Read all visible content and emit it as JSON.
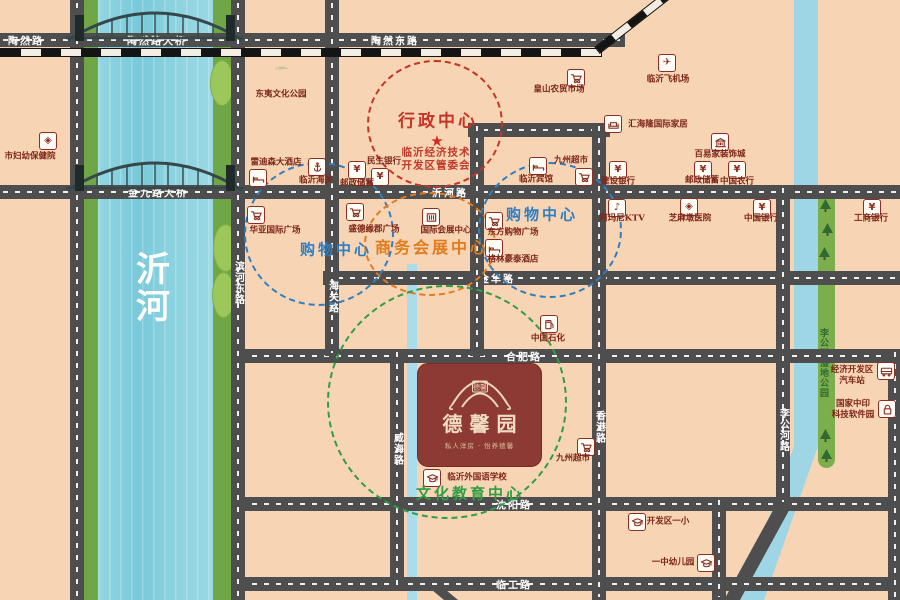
{
  "palette": {
    "bg": "#f7d4b4",
    "road": "#4e4e4e",
    "water": "#85cedd",
    "bank": "#6fa646",
    "canal": "#9fd6e6",
    "island": "#9cc75a",
    "zone_red": "#c43527",
    "zone_blue": "#2f7ec2",
    "zone_orange": "#e07b1e",
    "zone_green": "#2f9e44",
    "poi_text": "#7c2418",
    "project_bg": "#8c3a33"
  },
  "river": {
    "name": "沂河",
    "chars": [
      "沂",
      "河"
    ]
  },
  "parks": {
    "wetland_label": "李公河湿地公园"
  },
  "project": {
    "name": "德馨园",
    "seal": "德馨",
    "tagline": "私人洋房 · 怡养德馨"
  },
  "roads": {
    "h": [
      {
        "x": 0,
        "y": 33,
        "len": 625,
        "labels": [
          {
            "t": "陶然路",
            "at": 26
          },
          {
            "t": "陶然路大桥",
            "at": 157
          },
          {
            "t": "陶然东路",
            "at": 395
          }
        ]
      },
      {
        "x": 0,
        "y": 185,
        "len": 900,
        "labels": [
          {
            "t": "金九路大桥",
            "at": 158
          },
          {
            "t": "沂河路",
            "at": 450
          }
        ]
      },
      {
        "x": 323,
        "y": 271,
        "len": 577,
        "labels": [
          {
            "t": "金华路",
            "at": 497
          }
        ]
      },
      {
        "x": 237,
        "y": 349,
        "len": 663,
        "labels": [
          {
            "t": "合肥路",
            "at": 524
          }
        ]
      },
      {
        "x": 237,
        "y": 497,
        "len": 663,
        "labels": [
          {
            "t": "沈阳路",
            "at": 514
          }
        ]
      },
      {
        "x": 237,
        "y": 577,
        "len": 663,
        "labels": [
          {
            "t": "临工路",
            "at": 514
          }
        ]
      },
      {
        "x": 468,
        "y": 123,
        "len": 142,
        "labels": []
      }
    ],
    "v": [
      {
        "x": 70,
        "y": 0,
        "len": 600,
        "labels": []
      },
      {
        "x": 231,
        "y": 0,
        "len": 600,
        "labels": [
          {
            "t": "滨河东路",
            "at": 283
          }
        ]
      },
      {
        "x": 325,
        "y": 0,
        "len": 356,
        "labels": [
          {
            "t": "海关路",
            "at": 297
          }
        ]
      },
      {
        "x": 470,
        "y": 123,
        "len": 233,
        "labels": []
      },
      {
        "x": 592,
        "y": 123,
        "len": 477,
        "labels": [
          {
            "t": "香港路",
            "at": 427
          }
        ]
      },
      {
        "x": 390,
        "y": 349,
        "len": 241,
        "labels": [
          {
            "t": "威海路",
            "at": 449
          }
        ]
      },
      {
        "x": 776,
        "y": 185,
        "len": 320,
        "labels": [
          {
            "t": "李公河路",
            "at": 430
          }
        ]
      },
      {
        "x": 712,
        "y": 497,
        "len": 103,
        "labels": []
      },
      {
        "x": 888,
        "y": 349,
        "len": 251,
        "labels": []
      }
    ]
  },
  "zones": [
    {
      "label": "行政中心",
      "color": "#c43527",
      "cx": 433,
      "cy": 122,
      "rx": 66,
      "ry": 62,
      "lx": 438,
      "ly": 119,
      "fs": 17,
      "star": {
        "x": 437,
        "y": 141
      },
      "sub": [
        "临沂经济技术",
        "开发区管委会"
      ],
      "sub_x": 436,
      "sub_y": 159
    },
    {
      "label": "购物中心",
      "color": "#2f7ec2",
      "cx": 317,
      "cy": 232,
      "rx": 73,
      "ry": 70,
      "lx": 336,
      "ly": 249,
      "fs": 15
    },
    {
      "label": "购物中心",
      "color": "#2f7ec2",
      "cx": 548,
      "cy": 228,
      "rx": 70,
      "ry": 66,
      "lx": 542,
      "ly": 214,
      "fs": 15
    },
    {
      "label": "商务会展中心",
      "color": "#e07b1e",
      "cx": 428,
      "cy": 242,
      "rx": 64,
      "ry": 50,
      "lx": 432,
      "ly": 246,
      "fs": 16
    },
    {
      "label": "文化教育中心",
      "color": "#2f9e44",
      "cx": 445,
      "cy": 400,
      "rx": 118,
      "ry": 115,
      "lx": 470,
      "ly": 493,
      "fs": 15
    }
  ],
  "pois": [
    {
      "t": "市妇幼保健院",
      "icon": "hospital",
      "ix": 48,
      "iy": 141,
      "lx": 30,
      "ly": 157
    },
    {
      "t": "东夷文化公园",
      "icon": "mountains",
      "ix": 282,
      "iy": 68,
      "lx": 281,
      "ly": 95
    },
    {
      "t": "皇山农贸市场",
      "icon": "cart",
      "ix": 576,
      "iy": 78,
      "lx": 559,
      "ly": 90
    },
    {
      "t": "临沂飞机场",
      "icon": "plane",
      "ix": 667,
      "iy": 63,
      "lx": 668,
      "ly": 80
    },
    {
      "t": "汇海隆国际家居",
      "icon": "sofa",
      "ix": 613,
      "iy": 124,
      "lx": 658,
      "ly": 125
    },
    {
      "t": "百易家装饰城",
      "icon": "mall",
      "ix": 720,
      "iy": 142,
      "lx": 720,
      "ly": 155
    },
    {
      "t": "建设银行",
      "icon": "yen",
      "ix": 618,
      "iy": 170,
      "lx": 618,
      "ly": 182
    },
    {
      "t": "邮政储蓄",
      "icon": "yen",
      "ix": 703,
      "iy": 170,
      "lx": 702,
      "ly": 181
    },
    {
      "t": "中国农行",
      "icon": "yen",
      "ix": 737,
      "iy": 170,
      "lx": 737,
      "ly": 182
    },
    {
      "t": "雷迪森大酒店",
      "icon": "bed",
      "ix": 258,
      "iy": 178,
      "lx": 276,
      "ly": 163
    },
    {
      "t": "临沂海关",
      "icon": "anchor",
      "ix": 317,
      "iy": 167,
      "lx": 316,
      "ly": 181
    },
    {
      "t": "民生银行",
      "icon": "yen",
      "ix": 357,
      "iy": 170,
      "lx": 384,
      "ly": 162
    },
    {
      "t": "邮政储蓄",
      "icon": "yen",
      "ix": 380,
      "iy": 177,
      "lx": 357,
      "ly": 184
    },
    {
      "t": "临沂宾馆",
      "icon": "bed",
      "ix": 538,
      "iy": 166,
      "lx": 536,
      "ly": 180
    },
    {
      "t": "九州超市",
      "icon": "cart",
      "ix": 584,
      "iy": 177,
      "lx": 571,
      "ly": 161
    },
    {
      "t": "华亚国际广场",
      "icon": "cart",
      "ix": 256,
      "iy": 215,
      "lx": 275,
      "ly": 231
    },
    {
      "t": "盛德缘郡广场",
      "icon": "cart",
      "ix": 355,
      "iy": 212,
      "lx": 374,
      "ly": 230
    },
    {
      "t": "国际会展中心",
      "icon": "expo",
      "ix": 431,
      "iy": 217,
      "lx": 446,
      "ly": 231
    },
    {
      "t": "东方购物广场",
      "icon": "cart",
      "ix": 494,
      "iy": 221,
      "lx": 513,
      "ly": 233
    },
    {
      "t": "格林豪泰酒店",
      "icon": "bed",
      "ix": 494,
      "iy": 248,
      "lx": 513,
      "ly": 260
    },
    {
      "t": "阿玛尼KTV",
      "icon": "music",
      "ix": 617,
      "iy": 208,
      "lx": 622,
      "ly": 219
    },
    {
      "t": "芝麻墩医院",
      "icon": "hospital",
      "ix": 689,
      "iy": 207,
      "lx": 690,
      "ly": 219
    },
    {
      "t": "中国银行",
      "icon": "yen",
      "ix": 762,
      "iy": 208,
      "lx": 761,
      "ly": 219
    },
    {
      "t": "工商银行",
      "icon": "yen",
      "ix": 872,
      "iy": 208,
      "lx": 871,
      "ly": 219
    },
    {
      "t": "中国石化",
      "icon": "gas",
      "ix": 549,
      "iy": 324,
      "lx": 548,
      "ly": 339
    },
    {
      "t": "临沂外国语学校",
      "icon": "school",
      "ix": 432,
      "iy": 478,
      "lx": 477,
      "ly": 478
    },
    {
      "t": "九州超市",
      "icon": "cart",
      "ix": 586,
      "iy": 447,
      "lx": 573,
      "ly": 459
    },
    {
      "t": "开发区一小",
      "icon": "school",
      "ix": 637,
      "iy": 522,
      "lx": 668,
      "ly": 522
    },
    {
      "t": "一中幼儿园",
      "icon": "school",
      "ix": 706,
      "iy": 563,
      "lx": 673,
      "ly": 563
    },
    {
      "t": "经济开发区",
      "t2": "汽车站",
      "icon": "bus",
      "ix": 886,
      "iy": 371,
      "lx": 852,
      "ly": 376
    },
    {
      "t": "国家中印",
      "t2": "科技软件园",
      "icon": "lock",
      "ix": 887,
      "iy": 409,
      "lx": 853,
      "ly": 410
    }
  ],
  "trees": [
    {
      "x": 819,
      "y": 198
    },
    {
      "x": 821,
      "y": 222
    },
    {
      "x": 818,
      "y": 246
    },
    {
      "x": 819,
      "y": 428
    },
    {
      "x": 820,
      "y": 448
    }
  ],
  "islands": [
    {
      "x": 210,
      "y": 60,
      "w": 22,
      "h": 44
    },
    {
      "x": 213,
      "y": 224,
      "w": 23,
      "h": 46
    },
    {
      "x": 212,
      "y": 272,
      "w": 21,
      "h": 44
    }
  ]
}
